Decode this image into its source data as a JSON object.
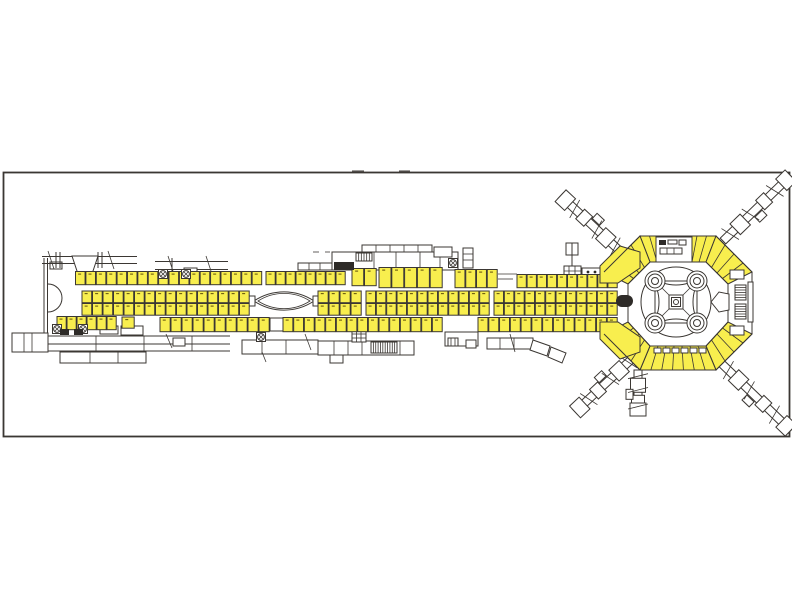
{
  "meta": {
    "label": "airport-terminal-floor-plan",
    "description": "CAD floor plan: long pier concourse with three rows of highlighted kiosk units, hexagonal satellite hub with rotunda and radiating jet bridges"
  },
  "palette": {
    "background": "#ffffff",
    "outline": "#3b3733",
    "highlight": "#f8ee4e",
    "dark": "#2e2b28",
    "frame": "#3b3733",
    "tick": "#6b5b10"
  },
  "frame": {
    "x": 3.5,
    "y": 172.5,
    "w": 786,
    "h": 264
  },
  "kiosk_rows": [
    {
      "name": "top-row-1",
      "x": 75.5,
      "y": 271.5,
      "w": 187,
      "h": 14,
      "n": 18,
      "double": false
    },
    {
      "name": "top-row-2",
      "x": 266,
      "y": 271.5,
      "w": 80,
      "h": 14,
      "n": 8,
      "double": false
    },
    {
      "name": "top-row-3-tall",
      "x": 352,
      "y": 268.5,
      "w": 25,
      "h": 18,
      "n": 2,
      "double": false
    },
    {
      "name": "top-row-4-large",
      "x": 379,
      "y": 267.5,
      "w": 64,
      "h": 21,
      "n": 5,
      "double": false
    },
    {
      "name": "top-row-5-large",
      "x": 455,
      "y": 269.5,
      "w": 43,
      "h": 19,
      "n": 4,
      "double": false
    },
    {
      "name": "top-row-6",
      "x": 517,
      "y": 274.5,
      "w": 101,
      "h": 14,
      "n": 10,
      "double": false
    },
    {
      "name": "mid-row-1",
      "x": 82,
      "y": 291,
      "w": 168,
      "h": 12.5,
      "n": 16,
      "double": true
    },
    {
      "name": "mid-row-2",
      "x": 318,
      "y": 291,
      "w": 44,
      "h": 12.5,
      "n": 4,
      "double": true
    },
    {
      "name": "mid-row-3",
      "x": 366,
      "y": 291,
      "w": 124,
      "h": 12.5,
      "n": 12,
      "double": true
    },
    {
      "name": "mid-row-4",
      "x": 494,
      "y": 291,
      "w": 124,
      "h": 12.5,
      "n": 12,
      "double": true
    },
    {
      "name": "bottom-row-1",
      "x": 57,
      "y": 316.5,
      "w": 60,
      "h": 14,
      "n": 6,
      "double": false
    },
    {
      "name": "bottom-row-2",
      "x": 122,
      "y": 317,
      "w": 13,
      "h": 12,
      "n": 1,
      "double": false
    },
    {
      "name": "bottom-row-3",
      "x": 160,
      "y": 317.5,
      "w": 110,
      "h": 15,
      "n": 10,
      "double": false
    },
    {
      "name": "bottom-row-4",
      "x": 283,
      "y": 317.5,
      "w": 160,
      "h": 15,
      "n": 15,
      "double": false
    },
    {
      "name": "bottom-row-5",
      "x": 478,
      "y": 317.5,
      "w": 140,
      "h": 15,
      "n": 13,
      "double": false
    }
  ],
  "jetways": [
    {
      "name": "jetway-hub-northwest",
      "x": 622,
      "y": 253,
      "angle": -137,
      "len": 84
    },
    {
      "name": "jetway-hub-northeast",
      "x": 723,
      "y": 241,
      "angle": -44,
      "len": 94
    },
    {
      "name": "jetway-hub-southeast",
      "x": 721,
      "y": 363,
      "angle": 44,
      "len": 97
    },
    {
      "name": "jetway-hub-southwest",
      "x": 635,
      "y": 356,
      "angle": 137,
      "len": 82
    },
    {
      "name": "jetway-hub-south-stub",
      "x": 638,
      "y": 370,
      "angle": 90,
      "len": 46
    }
  ],
  "hub_bands": [
    {
      "name": "hub-band-top-left",
      "o1": [
        640,
        236
      ],
      "o2": [
        678,
        236
      ],
      "i1": [
        650,
        262
      ],
      "i2": [
        678,
        262
      ],
      "n": 4
    },
    {
      "name": "hub-band-top-right",
      "o1": [
        678,
        236
      ],
      "o2": [
        716,
        236
      ],
      "i1": [
        678,
        262
      ],
      "i2": [
        706,
        262
      ],
      "n": 4
    },
    {
      "name": "hub-band-northeast",
      "o1": [
        716,
        236
      ],
      "o2": [
        752,
        272
      ],
      "i1": [
        706,
        262
      ],
      "i2": [
        728,
        284
      ],
      "n": 4
    },
    {
      "name": "hub-band-southeast",
      "o1": [
        752,
        334
      ],
      "o2": [
        716,
        370
      ],
      "i1": [
        728,
        322
      ],
      "i2": [
        706,
        346
      ],
      "n": 4
    },
    {
      "name": "hub-band-bottom",
      "o1": [
        716,
        370
      ],
      "o2": [
        640,
        370
      ],
      "i1": [
        706,
        346
      ],
      "i2": [
        650,
        346
      ],
      "n": 7
    },
    {
      "name": "hub-band-southwest",
      "o1": [
        640,
        370
      ],
      "o2": [
        604,
        334
      ],
      "i1": [
        650,
        346
      ],
      "i2": [
        628,
        322
      ],
      "n": 4
    },
    {
      "name": "hub-band-northwest",
      "o1": [
        604,
        272
      ],
      "o2": [
        640,
        236
      ],
      "i1": [
        628,
        284
      ],
      "i2": [
        650,
        262
      ],
      "n": 4
    }
  ],
  "entry_shops": [
    {
      "name": "hub-entry-shop-top",
      "points": [
        [
          600,
          266
        ],
        [
          620,
          246
        ],
        [
          640,
          252
        ],
        [
          640,
          268
        ],
        [
          618,
          283
        ],
        [
          600,
          283
        ]
      ]
    },
    {
      "name": "hub-entry-shop-bottom",
      "points": [
        [
          600,
          322
        ],
        [
          618,
          322
        ],
        [
          640,
          337
        ],
        [
          640,
          352
        ],
        [
          620,
          359
        ],
        [
          600,
          339
        ]
      ]
    }
  ],
  "rotunda": {
    "cx": 676,
    "cy": 302,
    "outer_r": 35,
    "square": [
      655,
      281,
      42
    ],
    "corner_ring_radii": [
      10,
      7,
      3.5
    ],
    "center_squares": [
      14,
      9
    ],
    "center_dot_r": 2.5
  },
  "crossed_circle_positions": [
    [
      163,
      274
    ],
    [
      186,
      274
    ],
    [
      453,
      263
    ],
    [
      57,
      329
    ],
    [
      83,
      329
    ],
    [
      261,
      337
    ]
  ],
  "dark_blocks": [
    [
      60,
      329,
      9,
      6
    ],
    [
      74,
      329,
      9,
      6
    ],
    [
      334,
      262,
      20,
      8
    ],
    [
      686,
      247,
      5,
      8
    ]
  ],
  "stairs_hatch": [
    {
      "name": "hub-east-stair-upper",
      "x": 735,
      "y": 285,
      "w": 11,
      "h": 15,
      "lines": 6,
      "dir": "h"
    },
    {
      "name": "hub-east-stair-lower",
      "x": 735,
      "y": 304,
      "w": 11,
      "h": 15,
      "lines": 6,
      "dir": "h"
    },
    {
      "name": "pier-service-stair",
      "x": 371,
      "y": 342,
      "w": 26,
      "h": 11,
      "lines": 11,
      "dir": "v"
    },
    {
      "name": "core-stair",
      "x": 356,
      "y": 253,
      "w": 16,
      "h": 8,
      "lines": 6,
      "dir": "v"
    }
  ]
}
